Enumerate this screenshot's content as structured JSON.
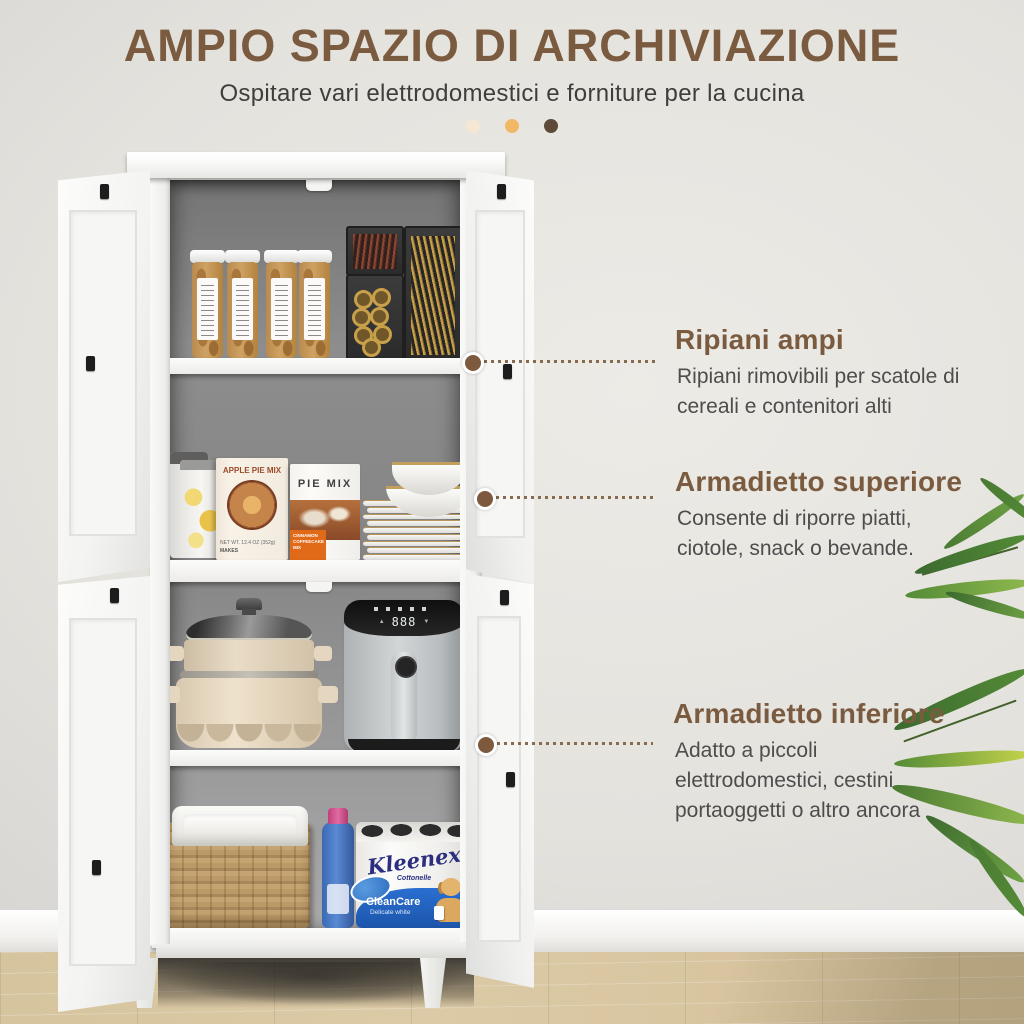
{
  "header": {
    "title": "AMPIO SPAZIO DI ARCHIVIAZIONE",
    "subtitle": "Ospitare vari elettrodomestici e forniture per la cucina",
    "dot_colors": [
      "#f5e7d3",
      "#f1b966",
      "#5d4a39"
    ]
  },
  "callouts": [
    {
      "title": "Ripiani ampi",
      "body": "Ripiani rimovibili per scatole di cereali e contenitori alti"
    },
    {
      "title": "Armadietto superiore",
      "body": "Consente di riporre piatti, ciotole, snack o bevande."
    },
    {
      "title": "Armadietto inferiore",
      "body": "Adatto a piccoli elettrodomestici, cestini portaoggetti o altro ancora"
    }
  ],
  "products": {
    "apple_pie_box": {
      "title": "APPLE PIE MIX",
      "net_weight": "NET WT. 12.4 OZ (352g)",
      "makes": "MAKES"
    },
    "pie_box": {
      "title": "PIE MIX",
      "band": "CINNAMON COFFEECAKE MIX"
    },
    "air_fryer": {
      "display": "888",
      "up_arrow": "▲",
      "down_arrow": "▼"
    },
    "kleenex": {
      "brand": "Kleenex",
      "sub_brand": "Cottonelle",
      "line1": "CleanCare",
      "line2": "Delicate white"
    }
  },
  "colors": {
    "accent_brown": "#7a5b40",
    "body_text": "#4d4d4d",
    "connector": "#7d5a3d",
    "wall": "#e4e2dd",
    "floor": "#d8c5a0"
  }
}
